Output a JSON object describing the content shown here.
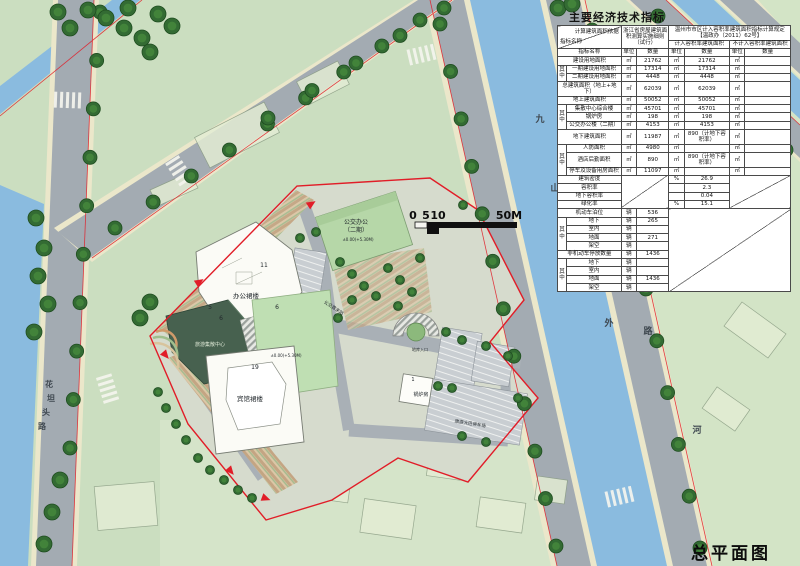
{
  "plan_title": "总平面图",
  "scalebar": {
    "l0": "0",
    "l5": "5",
    "l10": "10",
    "l50": "50M"
  },
  "table": {
    "title": "主要经济技术指标",
    "header": {
      "corner_top": "计算建筑面积依据",
      "corner_bottom": "指标名称",
      "basis1": "浙江省房屋建筑面积测算实施细则（试行）",
      "basis2": "温州市市区计入容积率建筑面积指标计算规定【温政办（2011）62号】",
      "sub1": "计入容积率建筑面积",
      "sub2": "不计入容积率建筑面积",
      "cols": [
        "指标名称",
        "单位",
        "数量",
        "单位",
        "数量",
        "单位",
        "数量"
      ]
    },
    "rows": [
      [
        {
          "t": "建设用地面积",
          "cs": 2,
          "cls": "nm"
        },
        {
          "t": "㎡"
        },
        {
          "t": "21762"
        },
        {
          "t": "㎡"
        },
        {
          "t": "21762"
        },
        {
          "t": "㎡"
        },
        {
          "t": ""
        }
      ],
      [
        {
          "t": "其中",
          "rs": 2,
          "cls": "grp"
        },
        {
          "t": "一期建设用地面积",
          "cls": "nm"
        },
        {
          "t": "㎡"
        },
        {
          "t": "17314"
        },
        {
          "t": "㎡"
        },
        {
          "t": "17314"
        },
        {
          "t": "㎡"
        },
        {
          "t": ""
        }
      ],
      [
        {
          "t": "二期建设用地面积",
          "cls": "nm"
        },
        {
          "t": "㎡"
        },
        {
          "t": "4448"
        },
        {
          "t": "㎡"
        },
        {
          "t": "4448"
        },
        {
          "t": "㎡"
        },
        {
          "t": ""
        }
      ],
      [
        {
          "t": "总建筑面积（地上+地下）",
          "cs": 2,
          "cls": "nm"
        },
        {
          "t": "㎡"
        },
        {
          "t": "62039"
        },
        {
          "t": "㎡"
        },
        {
          "t": "62039"
        },
        {
          "t": "㎡"
        },
        {
          "t": ""
        }
      ],
      [
        {
          "t": "地上建筑面积",
          "cs": 2,
          "cls": "nm"
        },
        {
          "t": "㎡"
        },
        {
          "t": "50052"
        },
        {
          "t": "㎡"
        },
        {
          "t": "50052"
        },
        {
          "t": "㎡"
        },
        {
          "t": ""
        }
      ],
      [
        {
          "t": "其中",
          "rs": 3,
          "cls": "grp"
        },
        {
          "t": "集散中心综合楼",
          "cls": "nm"
        },
        {
          "t": "㎡"
        },
        {
          "t": "45701"
        },
        {
          "t": "㎡"
        },
        {
          "t": "45701"
        },
        {
          "t": "㎡"
        },
        {
          "t": ""
        }
      ],
      [
        {
          "t": "锅炉房",
          "cls": "nm"
        },
        {
          "t": "㎡"
        },
        {
          "t": "198"
        },
        {
          "t": "㎡"
        },
        {
          "t": "198"
        },
        {
          "t": "㎡"
        },
        {
          "t": ""
        }
      ],
      [
        {
          "t": "公交办公楼（二期）",
          "cls": "nm"
        },
        {
          "t": "㎡"
        },
        {
          "t": "4153"
        },
        {
          "t": "㎡"
        },
        {
          "t": "4153"
        },
        {
          "t": "㎡"
        },
        {
          "t": ""
        }
      ],
      [
        {
          "t": "地下建筑面积",
          "cs": 2,
          "cls": "nm"
        },
        {
          "t": "㎡"
        },
        {
          "t": "11987"
        },
        {
          "t": "㎡"
        },
        {
          "t": "890（计地下容积率）"
        },
        {
          "t": "㎡"
        },
        {
          "t": ""
        }
      ],
      [
        {
          "t": "其中",
          "rs": 3,
          "cls": "grp"
        },
        {
          "t": "人防面积",
          "cls": "nm"
        },
        {
          "t": "㎡"
        },
        {
          "t": "4980"
        },
        {
          "t": "㎡"
        },
        {
          "t": ""
        },
        {
          "t": "㎡"
        },
        {
          "t": ""
        }
      ],
      [
        {
          "t": "酒店后勤面积",
          "cls": "nm"
        },
        {
          "t": "㎡"
        },
        {
          "t": "890"
        },
        {
          "t": "㎡"
        },
        {
          "t": "890（计地下容积率）"
        },
        {
          "t": "㎡"
        },
        {
          "t": ""
        }
      ],
      [
        {
          "t": "停车及设备用房面积",
          "cls": "nm"
        },
        {
          "t": "㎡"
        },
        {
          "t": "11097"
        },
        {
          "t": "㎡"
        },
        {
          "t": ""
        },
        {
          "t": "㎡"
        },
        {
          "t": ""
        }
      ],
      [
        {
          "t": "建筑密度",
          "cs": 2,
          "cls": "nm"
        },
        {
          "t": "",
          "cs": 2,
          "rs": 4,
          "cls": "diag"
        },
        {
          "t": "%"
        },
        {
          "t": "26.9"
        },
        {
          "t": "",
          "cs": 2,
          "rs": 4,
          "cls": "diag"
        }
      ],
      [
        {
          "t": "容积率",
          "cs": 2,
          "cls": "nm"
        },
        {
          "t": ""
        },
        {
          "t": "2.3"
        }
      ],
      [
        {
          "t": "地下容积率",
          "cs": 2,
          "cls": "nm"
        },
        {
          "t": ""
        },
        {
          "t": "0.04"
        }
      ],
      [
        {
          "t": "绿化率",
          "cs": 2,
          "cls": "nm"
        },
        {
          "t": "%"
        },
        {
          "t": "15.1"
        }
      ],
      [
        {
          "t": "机动车泊位",
          "cs": 2,
          "cls": "nm"
        },
        {
          "t": "辆"
        },
        {
          "t": "536"
        },
        {
          "t": "",
          "cs": 4,
          "rs": 10,
          "cls": "diag"
        }
      ],
      [
        {
          "t": "其中",
          "rs": 4,
          "cls": "grp"
        },
        {
          "t": "地下",
          "cls": "nm"
        },
        {
          "t": "辆"
        },
        {
          "t": "265"
        }
      ],
      [
        {
          "t": "室内",
          "cls": "nm"
        },
        {
          "t": "辆"
        },
        {
          "t": ""
        }
      ],
      [
        {
          "t": "地面",
          "cls": "nm"
        },
        {
          "t": "辆"
        },
        {
          "t": "271"
        }
      ],
      [
        {
          "t": "架空",
          "cls": "nm"
        },
        {
          "t": "辆"
        },
        {
          "t": ""
        }
      ],
      [
        {
          "t": "非机动车停放数量",
          "cs": 2,
          "cls": "nm"
        },
        {
          "t": "辆"
        },
        {
          "t": "1436"
        }
      ],
      [
        {
          "t": "其中",
          "rs": 4,
          "cls": "grp"
        },
        {
          "t": "地下",
          "cls": "nm"
        },
        {
          "t": "辆"
        },
        {
          "t": ""
        }
      ],
      [
        {
          "t": "室内",
          "cls": "nm"
        },
        {
          "t": "辆"
        },
        {
          "t": ""
        }
      ],
      [
        {
          "t": "地面",
          "cls": "nm"
        },
        {
          "t": "辆"
        },
        {
          "t": "1436"
        }
      ],
      [
        {
          "t": "架空",
          "cls": "nm"
        },
        {
          "t": "辆"
        },
        {
          "t": ""
        }
      ]
    ]
  },
  "map_labels": [
    {
      "t": "公交办公",
      "x": 356,
      "y": 224,
      "s": 6
    },
    {
      "t": "（二期）",
      "x": 356,
      "y": 232,
      "s": 6
    },
    {
      "t": "±0.00(+5.30M)",
      "x": 358,
      "y": 241,
      "s": 4
    },
    {
      "t": "办公裙楼",
      "x": 246,
      "y": 298,
      "s": 6.5
    },
    {
      "t": "11",
      "x": 264,
      "y": 267,
      "s": 6
    },
    {
      "t": "5",
      "x": 210,
      "y": 309,
      "s": 6
    },
    {
      "t": "6",
      "x": 221,
      "y": 320,
      "s": 6
    },
    {
      "t": "6",
      "x": 277,
      "y": 309,
      "s": 6
    },
    {
      "t": "旅游集散中心",
      "x": 210,
      "y": 346,
      "s": 5,
      "c": "#dfe9d6"
    },
    {
      "t": "±0.00(+5.30M)",
      "x": 286,
      "y": 357,
      "s": 4
    },
    {
      "t": "19",
      "x": 255,
      "y": 369,
      "s": 6
    },
    {
      "t": "宾馆裙楼",
      "x": 250,
      "y": 401,
      "s": 6.5
    },
    {
      "t": "锅炉房",
      "x": 421,
      "y": 396,
      "s": 5
    },
    {
      "t": "1",
      "x": 413,
      "y": 381,
      "s": 5
    },
    {
      "t": "地库入口",
      "x": 420,
      "y": 351,
      "s": 4
    },
    {
      "t": "公交首末站",
      "x": 333,
      "y": 309,
      "s": 4.5,
      "r": 33
    },
    {
      "t": "旅游大巴停车场",
      "x": 470,
      "y": 425,
      "s": 4.5,
      "r": 9
    },
    {
      "t": "九",
      "x": 540,
      "y": 122,
      "s": 9,
      "c": "#3f4850"
    },
    {
      "t": "山",
      "x": 555,
      "y": 191,
      "s": 9,
      "c": "#3f4850"
    },
    {
      "t": "外",
      "x": 609,
      "y": 326,
      "s": 9,
      "c": "#3f4850"
    },
    {
      "t": "路",
      "x": 648,
      "y": 334,
      "s": 9,
      "c": "#3f4850"
    },
    {
      "t": "河",
      "x": 697,
      "y": 433,
      "s": 9,
      "c": "#3f4850"
    },
    {
      "t": "花",
      "x": 49,
      "y": 387,
      "s": 8,
      "c": "#3f4850"
    },
    {
      "t": "坦",
      "x": 51,
      "y": 401,
      "s": 8,
      "c": "#3f4850"
    },
    {
      "t": "头",
      "x": 46,
      "y": 415,
      "s": 8,
      "c": "#3f4850"
    },
    {
      "t": "路",
      "x": 42,
      "y": 429,
      "s": 8,
      "c": "#3f4850"
    }
  ]
}
